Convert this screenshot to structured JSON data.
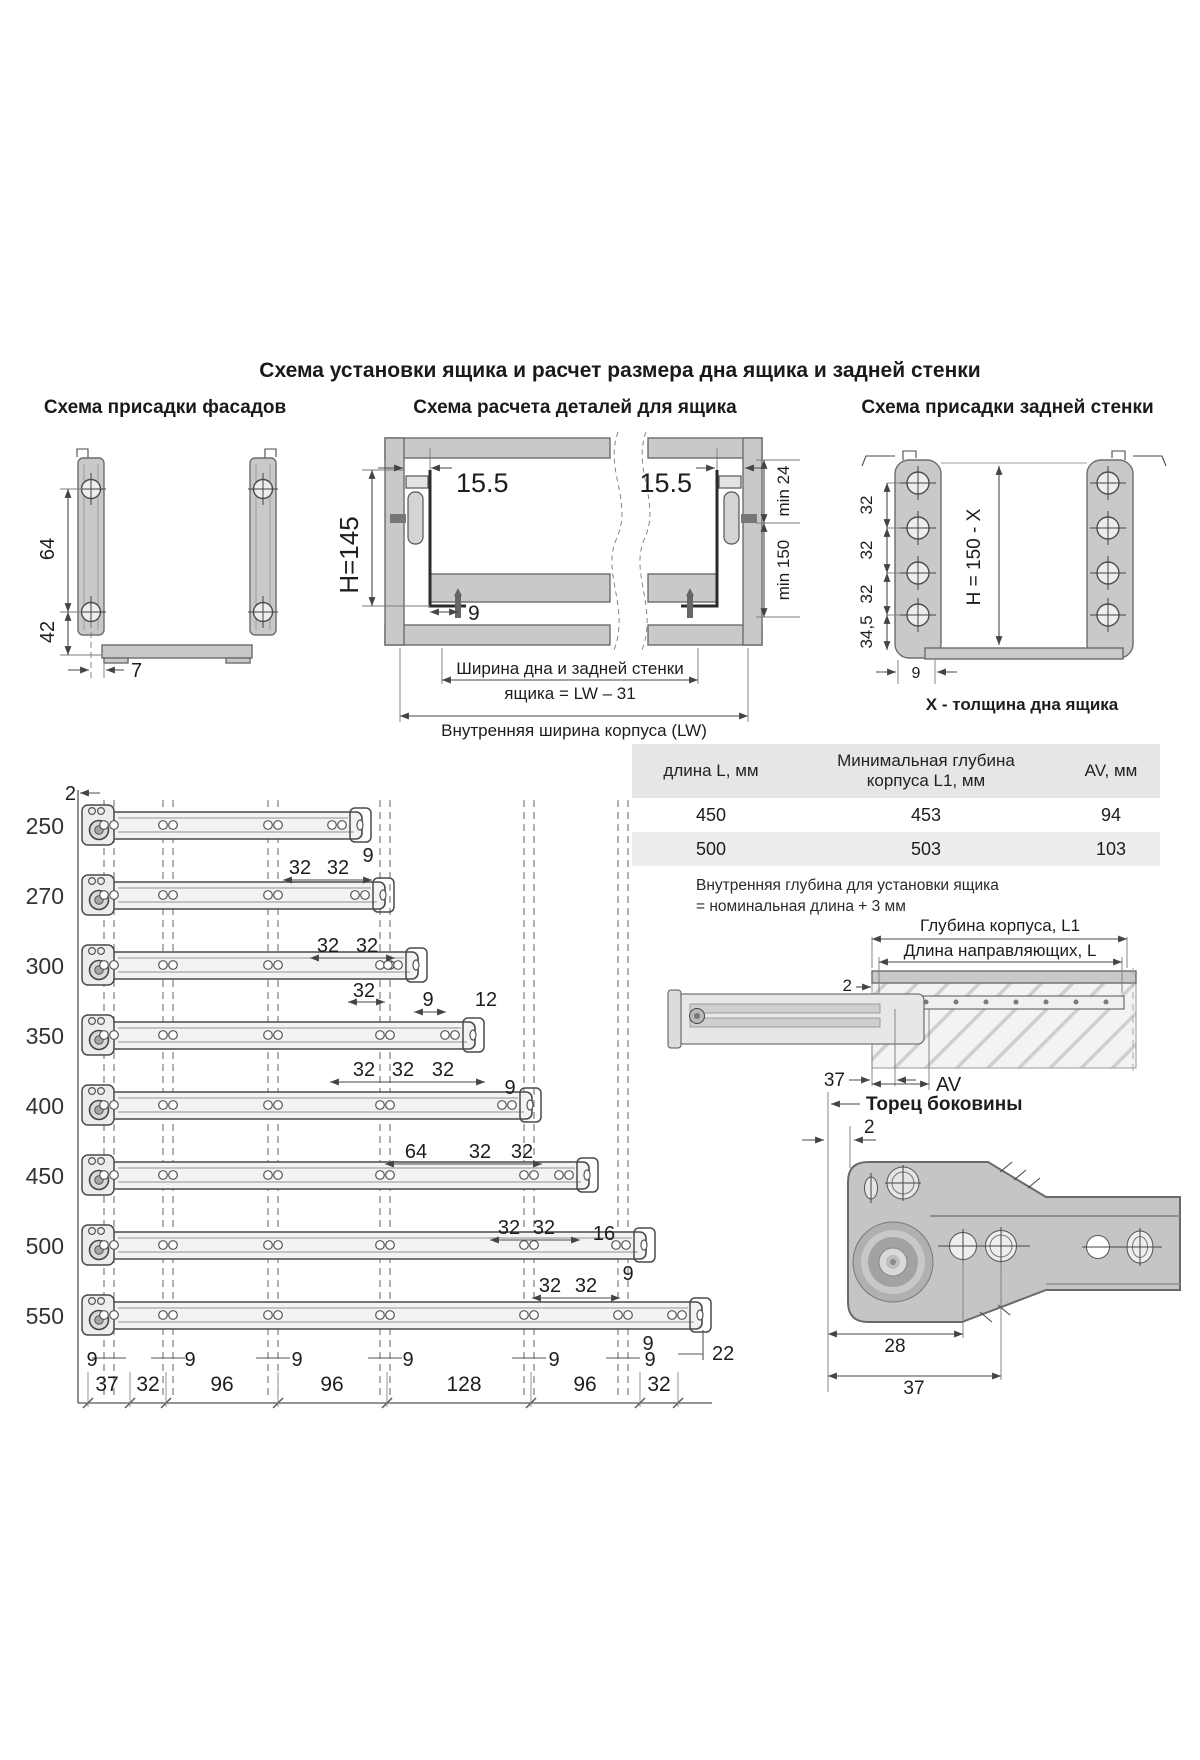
{
  "title": "Схема установки ящика и расчет размера дна ящика и задней стенки",
  "facades": {
    "title": "Схема присадки фасадов",
    "dim_64": "64",
    "dim_42": "42",
    "dim_7": "7"
  },
  "calc": {
    "title": "Схема расчета деталей для ящика",
    "dim_left": "15.5",
    "dim_right": "15.5",
    "dim_h": "H=145",
    "dim_9": "9",
    "dim_min24": "min 24",
    "dim_min150": "min 150",
    "width_line1": "Ширина дна и задней стенки",
    "width_line2": "ящика = LW – 31",
    "lw_label": "Внутренняя ширина корпуса (LW)"
  },
  "back": {
    "title": "Схема присадки задней стенки",
    "dim_32a": "32",
    "dim_32b": "32",
    "dim_32c": "32",
    "dim_34_5": "34,5",
    "dim_h": "H = 150 - X",
    "dim_9": "9",
    "caption": "X - толщина дна ящика"
  },
  "rails": {
    "dim_2": "2",
    "rows": [
      {
        "label": "250",
        "dims": [
          "32",
          "32",
          "9"
        ]
      },
      {
        "label": "270",
        "dims": [
          "32",
          "32"
        ]
      },
      {
        "label": "300",
        "dims": [
          "32",
          "9",
          "12"
        ]
      },
      {
        "label": "350",
        "dims": [
          "32",
          "32",
          "32"
        ]
      },
      {
        "label": "400",
        "dims": [
          "9",
          "64",
          "32",
          "32"
        ]
      },
      {
        "label": "450",
        "dims": [
          "32",
          "32",
          "16"
        ]
      },
      {
        "label": "500",
        "dims": [
          "32",
          "32",
          "9"
        ]
      },
      {
        "label": "550",
        "dims": [
          "9",
          "22"
        ]
      }
    ],
    "nine_row": [
      "9",
      "9",
      "9",
      "9",
      "9",
      "9"
    ],
    "bottom_dims": [
      "37",
      "32",
      "96",
      "96",
      "128",
      "96",
      "32"
    ]
  },
  "table": {
    "col1": "длина L, мм",
    "col2_line1": "Минимальная глубина",
    "col2_line2": "корпуса L1, мм",
    "col3": "AV, мм",
    "rows": [
      [
        "450",
        "453",
        "94"
      ],
      [
        "500",
        "503",
        "103"
      ]
    ],
    "note_line1": "Внутренняя глубина для установки ящика",
    "note_line2": "= номинальная длина + 3 мм"
  },
  "side_view": {
    "depth_label": "Глубина корпуса, L1",
    "rail_label": "Длина направляющих, L",
    "dim_2": "2",
    "dim_37": "37",
    "dim_av": "AV"
  },
  "end_view": {
    "title": "Торец боковины",
    "dim_2": "2",
    "dim_28": "28",
    "dim_37": "37"
  }
}
